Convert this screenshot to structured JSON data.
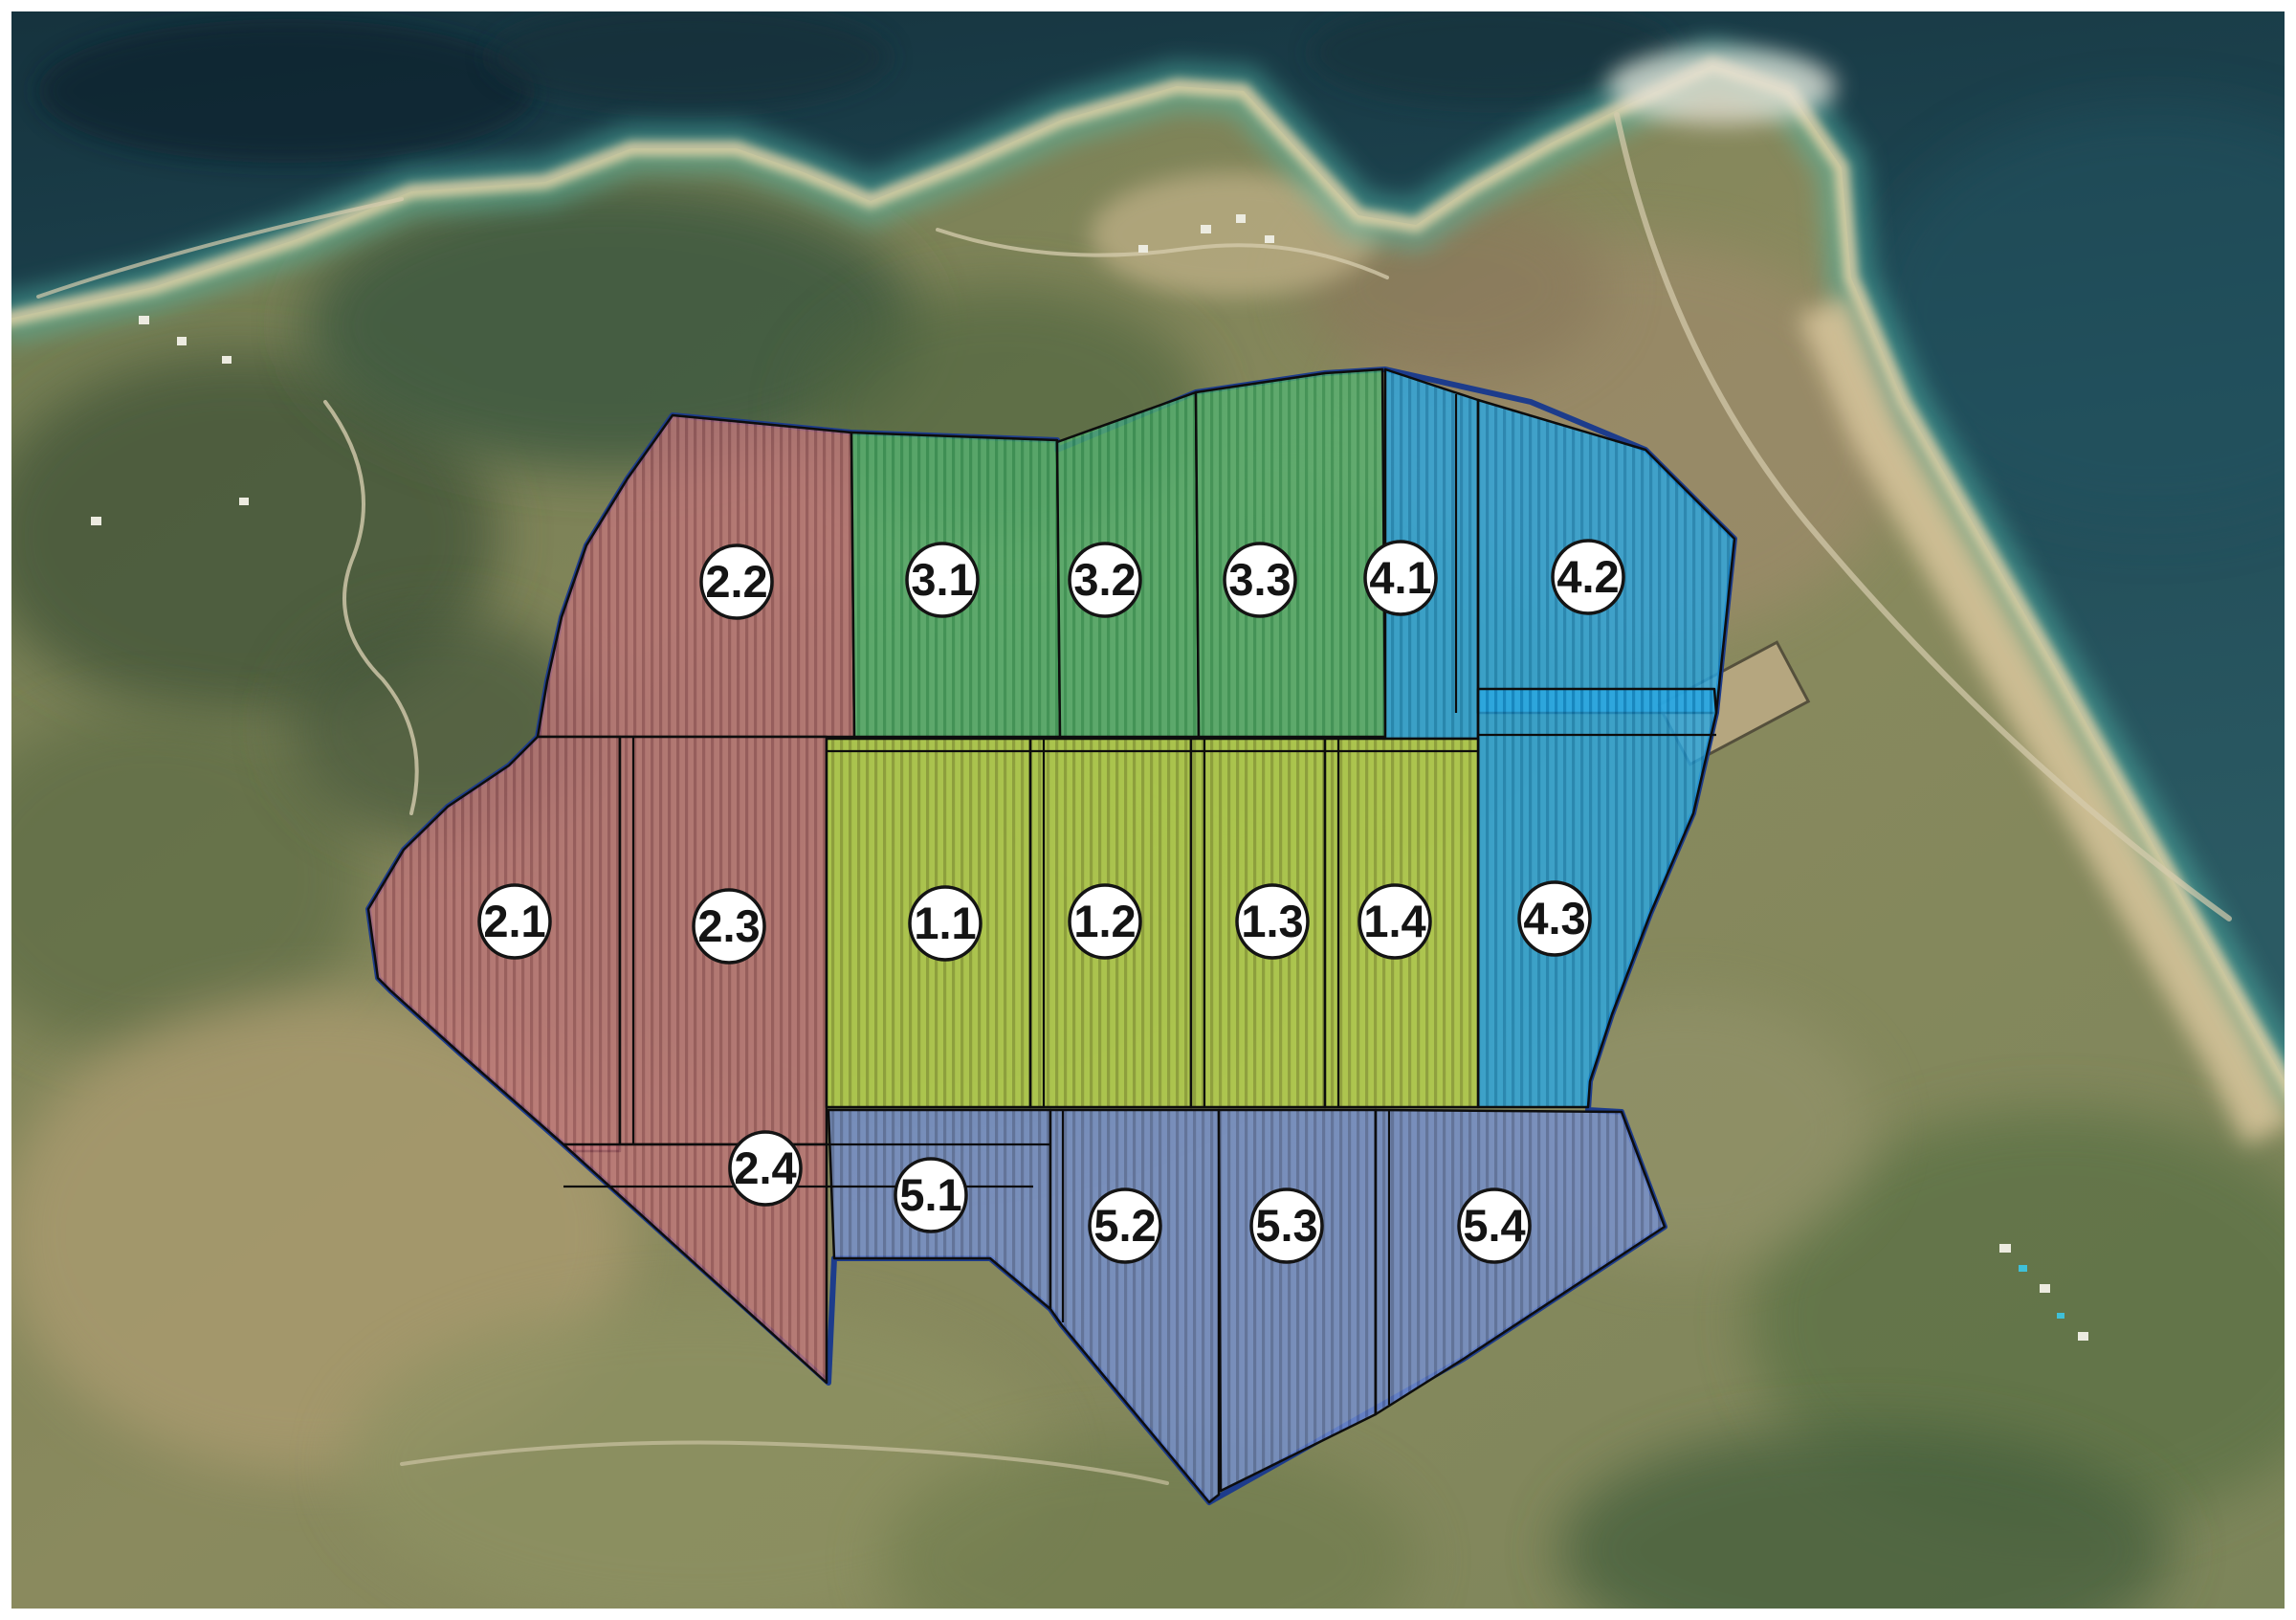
{
  "map": {
    "figure_type": "aerial-photo zone map",
    "groups": {
      "g1": {
        "name": "zone-group-1",
        "color": "#b7d44c",
        "stripe": "#92a637"
      },
      "g2": {
        "name": "zone-group-2",
        "color": "#c0767a",
        "stripe": "#9e565e"
      },
      "g3": {
        "name": "zone-group-3",
        "color": "#56b271",
        "stripe": "#379757"
      },
      "g4": {
        "name": "zone-group-4",
        "color": "#2aa7e2",
        "stripe": "#1487c2"
      },
      "g5": {
        "name": "zone-group-5",
        "color": "#7590d2",
        "stripe": "#5a6fa8"
      }
    },
    "label_style": {
      "circle_fill": "#ffffff",
      "text_color": "#141414"
    },
    "zones": [
      {
        "label": "2.2",
        "group": "g2"
      },
      {
        "label": "3.1",
        "group": "g3"
      },
      {
        "label": "3.2",
        "group": "g3"
      },
      {
        "label": "3.3",
        "group": "g3"
      },
      {
        "label": "4.1",
        "group": "g4"
      },
      {
        "label": "4.2",
        "group": "g4"
      },
      {
        "label": "2.1",
        "group": "g2"
      },
      {
        "label": "2.3",
        "group": "g2"
      },
      {
        "label": "1.1",
        "group": "g1"
      },
      {
        "label": "1.2",
        "group": "g1"
      },
      {
        "label": "1.3",
        "group": "g1"
      },
      {
        "label": "1.4",
        "group": "g1"
      },
      {
        "label": "4.3",
        "group": "g4"
      },
      {
        "label": "2.4",
        "group": "g2"
      },
      {
        "label": "5.1",
        "group": "g5"
      },
      {
        "label": "5.2",
        "group": "g5"
      },
      {
        "label": "5.3",
        "group": "g5"
      },
      {
        "label": "5.4",
        "group": "g5"
      }
    ]
  }
}
